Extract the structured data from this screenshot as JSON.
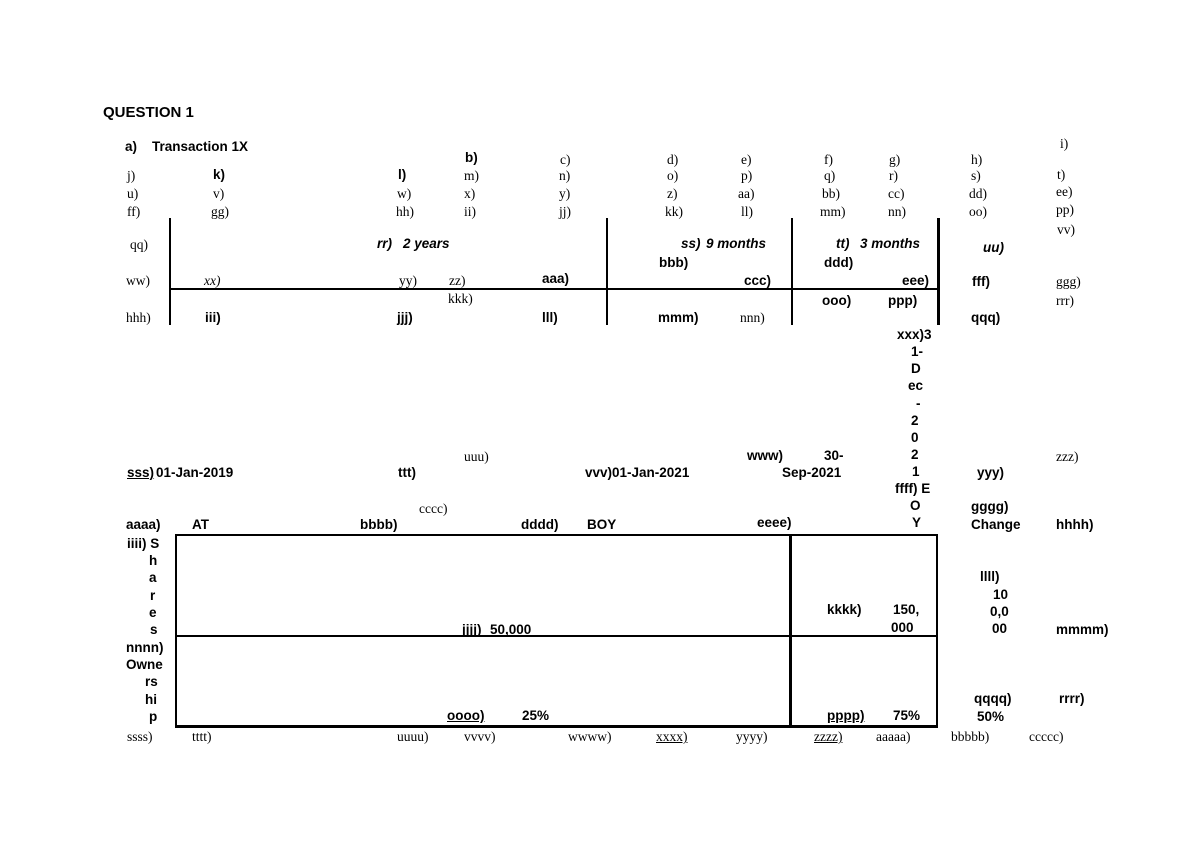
{
  "document": {
    "title": "QUESTION 1"
  },
  "colors": {
    "ink": "#000000",
    "paper": "#ffffff"
  },
  "labels": [
    {
      "t": "a)",
      "x": 125,
      "y": 139,
      "s": "b"
    },
    {
      "t": "Transaction 1X",
      "x": 152,
      "y": 139,
      "s": "b"
    },
    {
      "t": "b)",
      "x": 465,
      "y": 150,
      "s": "b"
    },
    {
      "t": "c)",
      "x": 560,
      "y": 152,
      "s": "r"
    },
    {
      "t": "d)",
      "x": 667,
      "y": 152,
      "s": "r"
    },
    {
      "t": "e)",
      "x": 741,
      "y": 152,
      "s": "r"
    },
    {
      "t": "f)",
      "x": 824,
      "y": 152,
      "s": "r"
    },
    {
      "t": "g)",
      "x": 889,
      "y": 152,
      "s": "r"
    },
    {
      "t": "h)",
      "x": 971,
      "y": 152,
      "s": "r"
    },
    {
      "t": "i)",
      "x": 1060,
      "y": 136,
      "s": "r"
    },
    {
      "t": "j)",
      "x": 127,
      "y": 168,
      "s": "r"
    },
    {
      "t": "k)",
      "x": 213,
      "y": 167,
      "s": "b"
    },
    {
      "t": "l)",
      "x": 398,
      "y": 167,
      "s": "b"
    },
    {
      "t": "m)",
      "x": 464,
      "y": 168,
      "s": "r"
    },
    {
      "t": "n)",
      "x": 559,
      "y": 168,
      "s": "r"
    },
    {
      "t": "o)",
      "x": 667,
      "y": 168,
      "s": "r"
    },
    {
      "t": "p)",
      "x": 741,
      "y": 168,
      "s": "r"
    },
    {
      "t": "q)",
      "x": 824,
      "y": 168,
      "s": "r"
    },
    {
      "t": "r)",
      "x": 889,
      "y": 168,
      "s": "r"
    },
    {
      "t": "s)",
      "x": 971,
      "y": 168,
      "s": "r"
    },
    {
      "t": "t)",
      "x": 1057,
      "y": 167,
      "s": "r"
    },
    {
      "t": "u)",
      "x": 127,
      "y": 186,
      "s": "r"
    },
    {
      "t": "v)",
      "x": 213,
      "y": 186,
      "s": "r"
    },
    {
      "t": "w)",
      "x": 397,
      "y": 186,
      "s": "r"
    },
    {
      "t": "x)",
      "x": 464,
      "y": 186,
      "s": "r"
    },
    {
      "t": "y)",
      "x": 559,
      "y": 186,
      "s": "r"
    },
    {
      "t": "z)",
      "x": 667,
      "y": 186,
      "s": "r"
    },
    {
      "t": "aa)",
      "x": 738,
      "y": 186,
      "s": "r"
    },
    {
      "t": "bb)",
      "x": 822,
      "y": 186,
      "s": "r"
    },
    {
      "t": "cc)",
      "x": 888,
      "y": 186,
      "s": "r"
    },
    {
      "t": "dd)",
      "x": 969,
      "y": 186,
      "s": "r"
    },
    {
      "t": "ee)",
      "x": 1056,
      "y": 184,
      "s": "r"
    },
    {
      "t": "ff)",
      "x": 127,
      "y": 204,
      "s": "r"
    },
    {
      "t": "gg)",
      "x": 211,
      "y": 204,
      "s": "r"
    },
    {
      "t": "hh)",
      "x": 396,
      "y": 204,
      "s": "r"
    },
    {
      "t": "ii)",
      "x": 464,
      "y": 204,
      "s": "r"
    },
    {
      "t": "jj)",
      "x": 559,
      "y": 204,
      "s": "r"
    },
    {
      "t": "kk)",
      "x": 665,
      "y": 204,
      "s": "r"
    },
    {
      "t": "ll)",
      "x": 741,
      "y": 204,
      "s": "r"
    },
    {
      "t": "mm)",
      "x": 820,
      "y": 204,
      "s": "r"
    },
    {
      "t": "nn)",
      "x": 888,
      "y": 204,
      "s": "r"
    },
    {
      "t": "oo)",
      "x": 969,
      "y": 204,
      "s": "r"
    },
    {
      "t": "pp)",
      "x": 1056,
      "y": 202,
      "s": "r"
    },
    {
      "t": "vv)",
      "x": 1057,
      "y": 222,
      "s": "r"
    },
    {
      "t": "qq)",
      "x": 130,
      "y": 237,
      "s": "r"
    },
    {
      "t": "rr)",
      "x": 377,
      "y": 236,
      "s": "bi"
    },
    {
      "t": "2 years",
      "x": 403,
      "y": 236,
      "s": "bi"
    },
    {
      "t": "ss)",
      "x": 681,
      "y": 236,
      "s": "bi"
    },
    {
      "t": "9 months",
      "x": 706,
      "y": 236,
      "s": "bi"
    },
    {
      "t": "tt)",
      "x": 836,
      "y": 236,
      "s": "bi"
    },
    {
      "t": "3 months",
      "x": 860,
      "y": 236,
      "s": "bi"
    },
    {
      "t": "uu)",
      "x": 983,
      "y": 240,
      "s": "bi"
    },
    {
      "t": "bbb)",
      "x": 659,
      "y": 255,
      "s": "b"
    },
    {
      "t": "ddd)",
      "x": 824,
      "y": 255,
      "s": "b"
    },
    {
      "t": "ww)",
      "x": 126,
      "y": 273,
      "s": "r"
    },
    {
      "t": "xx)",
      "x": 204,
      "y": 273,
      "s": "ri"
    },
    {
      "t": "yy)",
      "x": 399,
      "y": 273,
      "s": "r"
    },
    {
      "t": "zz)",
      "x": 449,
      "y": 273,
      "s": "r"
    },
    {
      "t": "aaa)",
      "x": 542,
      "y": 271,
      "s": "b"
    },
    {
      "t": "ccc)",
      "x": 744,
      "y": 273,
      "s": "b"
    },
    {
      "t": "eee)",
      "x": 902,
      "y": 273,
      "s": "b"
    },
    {
      "t": "fff)",
      "x": 972,
      "y": 274,
      "s": "b"
    },
    {
      "t": "ggg)",
      "x": 1056,
      "y": 274,
      "s": "r"
    },
    {
      "t": "kkk)",
      "x": 448,
      "y": 291,
      "s": "r"
    },
    {
      "t": "ooo)",
      "x": 822,
      "y": 293,
      "s": "b"
    },
    {
      "t": "ppp)",
      "x": 888,
      "y": 293,
      "s": "b"
    },
    {
      "t": "rrr)",
      "x": 1056,
      "y": 293,
      "s": "r"
    },
    {
      "t": "hhh)",
      "x": 126,
      "y": 310,
      "s": "r"
    },
    {
      "t": "iii)",
      "x": 205,
      "y": 310,
      "s": "b"
    },
    {
      "t": "jjj)",
      "x": 397,
      "y": 310,
      "s": "b"
    },
    {
      "t": "lll)",
      "x": 542,
      "y": 310,
      "s": "b"
    },
    {
      "t": "mmm)",
      "x": 658,
      "y": 310,
      "s": "b"
    },
    {
      "t": "nnn)",
      "x": 740,
      "y": 310,
      "s": "r"
    },
    {
      "t": "qqq)",
      "x": 971,
      "y": 310,
      "s": "b"
    },
    {
      "t": "xxx)3",
      "x": 897,
      "y": 327,
      "s": "b"
    },
    {
      "t": "1-",
      "x": 911,
      "y": 344,
      "s": "b"
    },
    {
      "t": "D",
      "x": 911,
      "y": 361,
      "s": "b"
    },
    {
      "t": "ec",
      "x": 908,
      "y": 378,
      "s": "b"
    },
    {
      "t": "-",
      "x": 916,
      "y": 396,
      "s": "b"
    },
    {
      "t": "2",
      "x": 911,
      "y": 413,
      "s": "b"
    },
    {
      "t": "0",
      "x": 911,
      "y": 430,
      "s": "b"
    },
    {
      "t": "2",
      "x": 911,
      "y": 447,
      "s": "b"
    },
    {
      "t": "1",
      "x": 912,
      "y": 464,
      "s": "b"
    },
    {
      "t": "ffff) E",
      "x": 895,
      "y": 481,
      "s": "b"
    },
    {
      "t": "O",
      "x": 910,
      "y": 498,
      "s": "b"
    },
    {
      "t": "Y",
      "x": 912,
      "y": 515,
      "s": "b"
    },
    {
      "t": "sss)",
      "x": 127,
      "y": 465,
      "s": "bu"
    },
    {
      "t": "01-Jan-2019",
      "x": 156,
      "y": 465,
      "s": "b"
    },
    {
      "t": "ttt)",
      "x": 398,
      "y": 465,
      "s": "b"
    },
    {
      "t": "uuu)",
      "x": 464,
      "y": 449,
      "s": "r"
    },
    {
      "t": "vvv)01-Jan-2021",
      "x": 585,
      "y": 465,
      "s": "b"
    },
    {
      "t": "www)",
      "x": 747,
      "y": 448,
      "s": "b"
    },
    {
      "t": "30-",
      "x": 824,
      "y": 448,
      "s": "b"
    },
    {
      "t": "Sep-2021",
      "x": 782,
      "y": 465,
      "s": "b"
    },
    {
      "t": "yyy)",
      "x": 977,
      "y": 465,
      "s": "b"
    },
    {
      "t": "zzz)",
      "x": 1056,
      "y": 449,
      "s": "r"
    },
    {
      "t": "gggg)",
      "x": 971,
      "y": 499,
      "s": "b"
    },
    {
      "t": "Change",
      "x": 971,
      "y": 517,
      "s": "b"
    },
    {
      "t": "hhhh)",
      "x": 1056,
      "y": 517,
      "s": "b"
    },
    {
      "t": "aaaa)",
      "x": 126,
      "y": 517,
      "s": "b"
    },
    {
      "t": "AT",
      "x": 192,
      "y": 517,
      "s": "b"
    },
    {
      "t": "bbbb)",
      "x": 360,
      "y": 517,
      "s": "b"
    },
    {
      "t": "cccc)",
      "x": 419,
      "y": 501,
      "s": "r"
    },
    {
      "t": "dddd)",
      "x": 521,
      "y": 517,
      "s": "b"
    },
    {
      "t": "BOY",
      "x": 587,
      "y": 517,
      "s": "b"
    },
    {
      "t": "eeee)",
      "x": 757,
      "y": 515,
      "s": "b"
    },
    {
      "t": "iiii) S",
      "x": 127,
      "y": 536,
      "s": "b"
    },
    {
      "t": "h",
      "x": 149,
      "y": 553,
      "s": "b"
    },
    {
      "t": "a",
      "x": 149,
      "y": 570,
      "s": "b"
    },
    {
      "t": "r",
      "x": 150,
      "y": 588,
      "s": "b"
    },
    {
      "t": "e",
      "x": 149,
      "y": 605,
      "s": "b"
    },
    {
      "t": "s",
      "x": 150,
      "y": 622,
      "s": "b"
    },
    {
      "t": "nnnn)",
      "x": 126,
      "y": 640,
      "s": "b"
    },
    {
      "t": "Owne",
      "x": 126,
      "y": 657,
      "s": "b"
    },
    {
      "t": "rs",
      "x": 145,
      "y": 674,
      "s": "b"
    },
    {
      "t": "hi",
      "x": 145,
      "y": 692,
      "s": "b"
    },
    {
      "t": "p",
      "x": 149,
      "y": 709,
      "s": "b"
    },
    {
      "t": "jjjj)",
      "x": 462,
      "y": 622,
      "s": "bu"
    },
    {
      "t": "50,000",
      "x": 490,
      "y": 622,
      "s": "b"
    },
    {
      "t": "kkkk)",
      "x": 827,
      "y": 602,
      "s": "b"
    },
    {
      "t": "150,",
      "x": 893,
      "y": 602,
      "s": "b"
    },
    {
      "t": "000",
      "x": 891,
      "y": 620,
      "s": "b"
    },
    {
      "t": "llll)",
      "x": 980,
      "y": 569,
      "s": "b"
    },
    {
      "t": "10",
      "x": 993,
      "y": 587,
      "s": "b"
    },
    {
      "t": "0,0",
      "x": 990,
      "y": 604,
      "s": "b"
    },
    {
      "t": "00",
      "x": 992,
      "y": 621,
      "s": "b"
    },
    {
      "t": "mmmm)",
      "x": 1056,
      "y": 622,
      "s": "b"
    },
    {
      "t": "oooo)",
      "x": 447,
      "y": 708,
      "s": "bu"
    },
    {
      "t": "25%",
      "x": 522,
      "y": 708,
      "s": "b"
    },
    {
      "t": "pppp)",
      "x": 827,
      "y": 708,
      "s": "bu"
    },
    {
      "t": "75%",
      "x": 893,
      "y": 708,
      "s": "b"
    },
    {
      "t": "qqqq)",
      "x": 974,
      "y": 691,
      "s": "b"
    },
    {
      "t": "50%",
      "x": 977,
      "y": 709,
      "s": "b"
    },
    {
      "t": "rrrr)",
      "x": 1059,
      "y": 691,
      "s": "b"
    },
    {
      "t": "ssss)",
      "x": 127,
      "y": 729,
      "s": "r"
    },
    {
      "t": "tttt)",
      "x": 192,
      "y": 729,
      "s": "r"
    },
    {
      "t": "uuuu)",
      "x": 397,
      "y": 729,
      "s": "r"
    },
    {
      "t": "vvvv)",
      "x": 464,
      "y": 729,
      "s": "r"
    },
    {
      "t": "wwww)",
      "x": 568,
      "y": 729,
      "s": "r"
    },
    {
      "t": "xxxx)",
      "x": 656,
      "y": 729,
      "s": "ru"
    },
    {
      "t": "yyyy)",
      "x": 736,
      "y": 729,
      "s": "r"
    },
    {
      "t": "zzzz)",
      "x": 814,
      "y": 729,
      "s": "ru"
    },
    {
      "t": "aaaaa)",
      "x": 876,
      "y": 729,
      "s": "r"
    },
    {
      "t": "bbbbb)",
      "x": 951,
      "y": 729,
      "s": "r"
    },
    {
      "t": "ccccc)",
      "x": 1029,
      "y": 729,
      "s": "r"
    }
  ],
  "lines": [
    {
      "name": "timeline-tick-1",
      "x": 169,
      "y": 218,
      "w": 2,
      "h": 107
    },
    {
      "name": "timeline-tick-2",
      "x": 606,
      "y": 218,
      "w": 2,
      "h": 107
    },
    {
      "name": "timeline-tick-3",
      "x": 791,
      "y": 218,
      "w": 2,
      "h": 107
    },
    {
      "name": "timeline-tick-4",
      "x": 937,
      "y": 218,
      "w": 3,
      "h": 107
    },
    {
      "name": "timeline-axis",
      "x": 169,
      "y": 288,
      "w": 771,
      "h": 2
    },
    {
      "name": "table-border-top",
      "x": 175,
      "y": 534,
      "w": 763,
      "h": 2
    },
    {
      "name": "table-border-left",
      "x": 175,
      "y": 534,
      "w": 2,
      "h": 194
    },
    {
      "name": "table-border-right",
      "x": 936,
      "y": 534,
      "w": 2,
      "h": 194
    },
    {
      "name": "table-border-bottom",
      "x": 175,
      "y": 725,
      "w": 763,
      "h": 3
    },
    {
      "name": "table-divider-vertical",
      "x": 789,
      "y": 534,
      "w": 3,
      "h": 194
    },
    {
      "name": "table-divider-horizontal",
      "x": 175,
      "y": 635,
      "w": 763,
      "h": 2
    }
  ]
}
